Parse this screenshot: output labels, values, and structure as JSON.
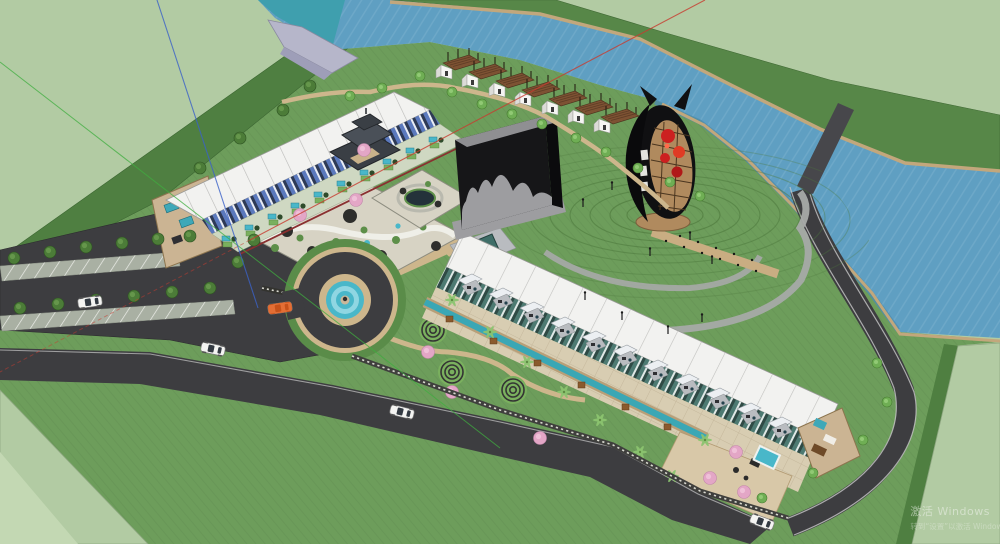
{
  "meta": {
    "view_type": "3d-model-viewport",
    "description": "Aerial axonometric rendering of a riverside glamping resort master plan with hotel rows, cabins, observation tower, art block, fountain roundabout, rock gardens, parking lot and a river"
  },
  "watermark": {
    "line1": "激活 Windows",
    "line2": "转到“设置”以激活 Windows。"
  },
  "scene": {
    "terrain": {
      "outer_field": "pale green ground plane",
      "site_plateau": "main resort lawn",
      "embankment": "dark green slope band",
      "far_bank": "river far bank slope"
    },
    "water": {
      "river": "river crossing top-right",
      "head_pond": "teal river head",
      "canal": "landscape water channel",
      "dam": "grey spillway wedge"
    },
    "buildings": {
      "hotel_row_upper": {
        "label": "blue-striped hotel row with white roof",
        "unit_gardens": 10,
        "gate": "chinese pagoda gate"
      },
      "hotel_row_lower": {
        "label": "teal-striped hotel row with white roof",
        "porch_units": 12,
        "end_suite": "open-roof suite with plunge pool"
      },
      "glamping_cabins": {
        "count": 7,
        "label": "timber-canopy tent cabins along river"
      },
      "black_monolith": "black art block with grey melt facade",
      "observation_tower": "oval black tower with red pods on contour mound"
    },
    "landscape": {
      "fountain_roundabout": "circular drive with tiered blue fountain",
      "rock_gardens": 2,
      "spiral_lawn_art": 3,
      "contour_mound": "concentric terraced lawn rings",
      "boardwalk": "timber walkway to tower"
    },
    "parking": {
      "stall_rows": 2,
      "label": "angled-stall parking lot"
    },
    "vehicles": {
      "white_cars": 4,
      "orange_cars": 1
    },
    "axes": {
      "red": "red model axis",
      "green": "green model axis",
      "blue": "blue model axis"
    }
  },
  "palette": {
    "pale": "#b2cba3",
    "pale2": "#c3d8b3",
    "site": "#6d9d5b",
    "bank": "#4f7f41",
    "farbank": "#578748",
    "river": "#5f9fc2",
    "riveredge": "#4d8cb0",
    "tealhead": "#3f9fae",
    "dam": "#b6b6ca",
    "road": "#3d3d40",
    "curb": "#c8c8c8",
    "stall": "#a9b0a3",
    "tan": "#cdb68c",
    "board": "#c9ad82",
    "stone": "#d7d3c4",
    "walk": "#d8cdb2",
    "roof": "#f2f2f0",
    "hedge": "#5a8c49",
    "contour": "#4e7a3e",
    "chan": "#3aa7b5",
    "fount": "#49b7c9",
    "treedark": "#4c7c38",
    "treebright": "#6fae54",
    "palm": "#8cc470",
    "cherry": "#e3a6c6",
    "cabinroof": "#7d5233",
    "white": "#f5f5f2",
    "mono": "#161618",
    "monogray": "#9d9da0",
    "towerdark": "#101012",
    "towerred": "#cc2020",
    "towertan": "#b08a5e",
    "axisred": "#c83c30",
    "axisgreen": "#3fae3f",
    "axisblue": "#3b62c8"
  }
}
